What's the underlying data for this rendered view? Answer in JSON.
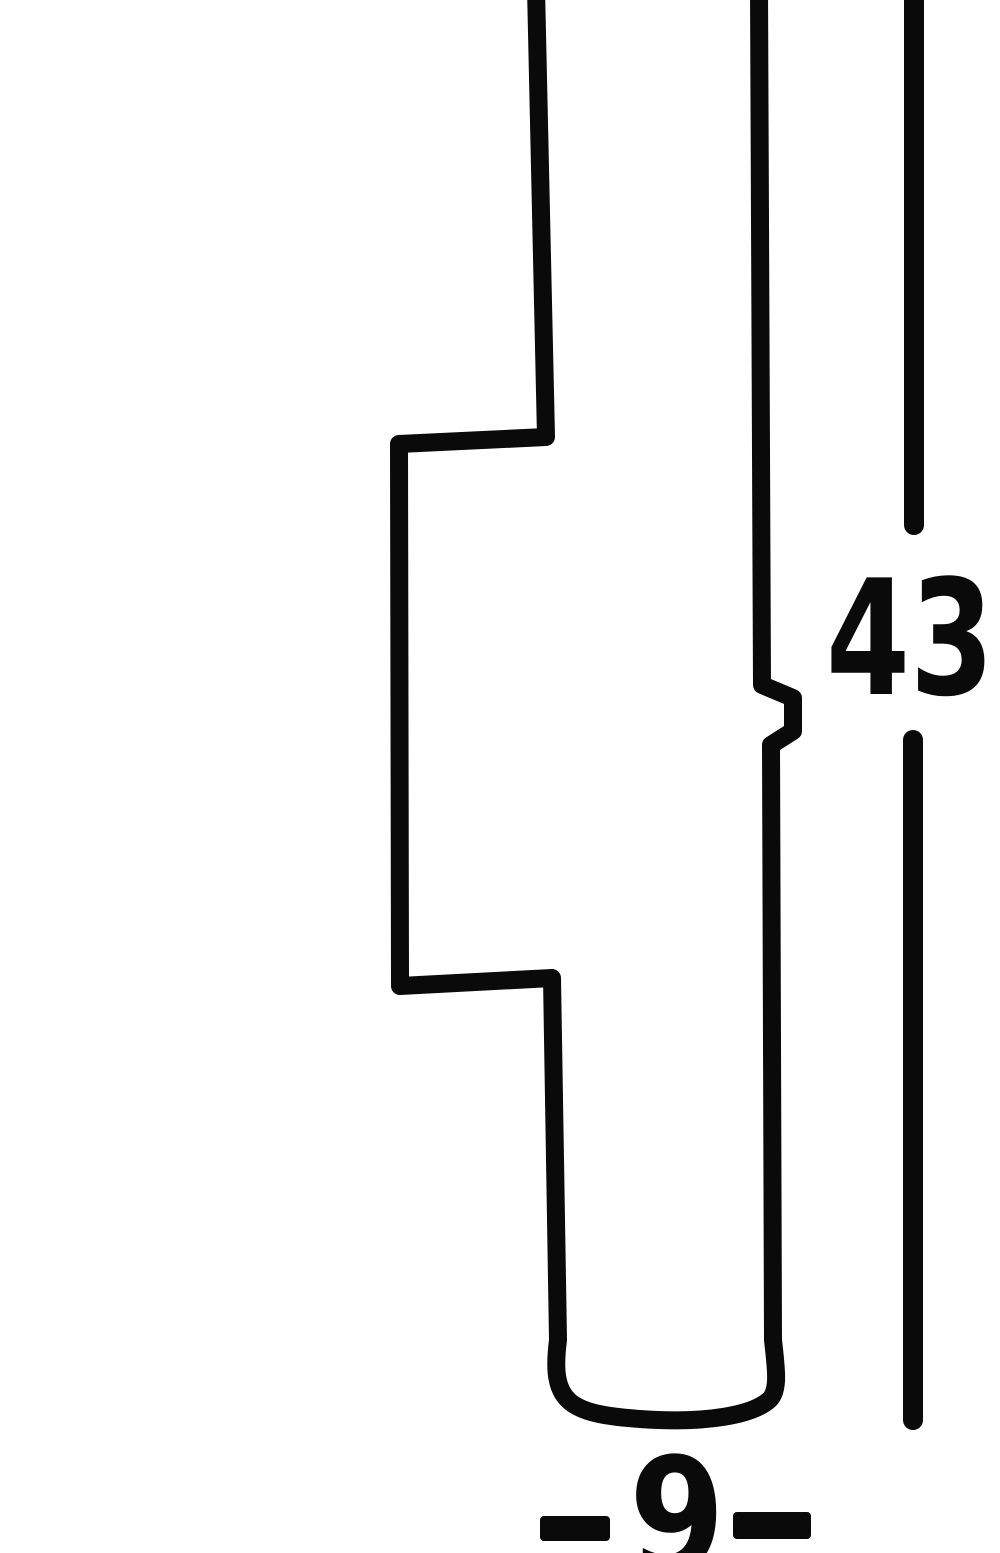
{
  "diagram": {
    "kind": "product-dimension-drawing",
    "subject": "stepped cylindrical fixture profile (cropped at top)",
    "labels": {
      "height_value": "43",
      "width_value": "9"
    },
    "colors": {
      "ink": "#0a0a0a",
      "background": "#ffffff"
    }
  }
}
